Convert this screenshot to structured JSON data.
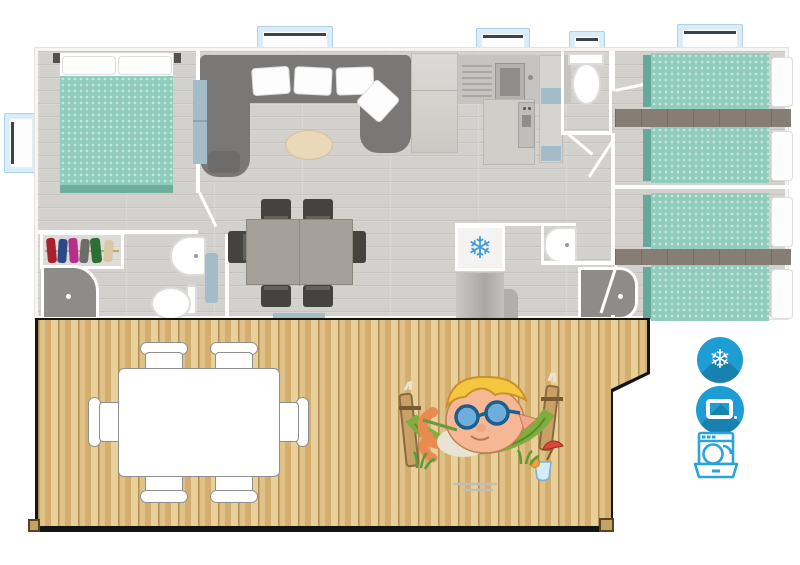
{
  "page": {
    "title": "Mobile home top-view floor plan with terrace",
    "background": "#ffffff"
  },
  "glyphs": {
    "snowflake": "❄"
  },
  "colors": {
    "icon_blue": "#1e9cd4",
    "icon_outline_blue": "#2aa3dc",
    "bed_teal": "#8fccbc",
    "floor_gray": "#d3d1cd",
    "deck_wood": "#d9b877",
    "sofa_gray": "#7a7876",
    "accent_blue_gray": "#a3bdc8",
    "window_frame_blue": "#d9ecf7"
  },
  "amenities": [
    {
      "name": "air-conditioning",
      "icon": "snowflake-icon"
    },
    {
      "name": "television",
      "icon": "tv-icon"
    },
    {
      "name": "dishwasher",
      "icon": "dishwasher-icon"
    }
  ],
  "floorplan": {
    "rooms": [
      "master-bedroom",
      "master-ensuite",
      "living-room",
      "kitchen",
      "wc",
      "bathroom",
      "hallway",
      "twin-bedroom-1",
      "twin-bedroom-2"
    ],
    "furniture": [
      "double-bed",
      "wardrobe",
      "shower",
      "washbasin",
      "toilet",
      "corner-sofa",
      "coffee-table",
      "dining-table",
      "six-chairs",
      "kitchen-sink",
      "oven",
      "fridge",
      "single-bed-x4"
    ]
  },
  "deck": {
    "furniture": [
      "outdoor-table",
      "outdoor-chairs-x6",
      "hammock-mascot"
    ]
  }
}
